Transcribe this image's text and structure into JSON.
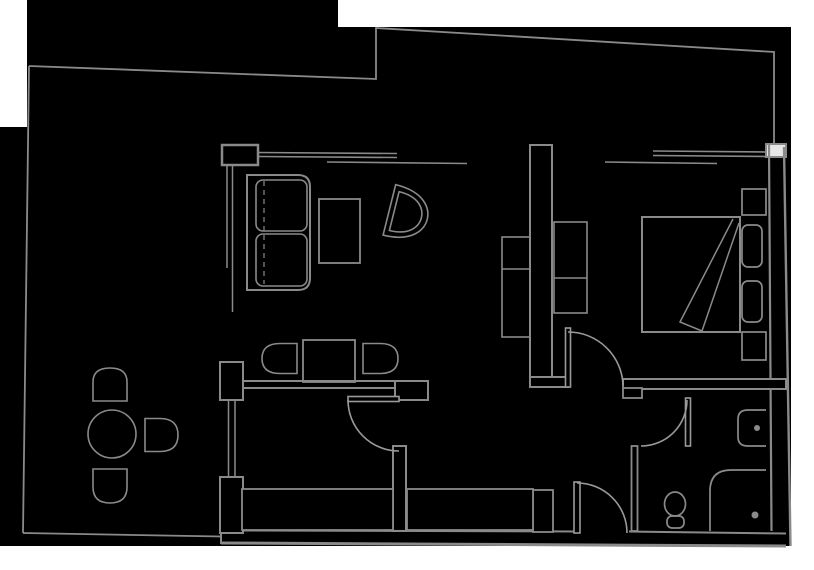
{
  "plan": {
    "title": "apartment-floor-plan",
    "background_color": "#000000",
    "margin_color": "#ffffff",
    "line_color": "#8a8a8a",
    "wall_fill_color": "#000000",
    "corner_block_fill": "#e6e6e6",
    "rooms": [
      {
        "name": "terrace",
        "side": "left"
      },
      {
        "name": "living-room",
        "side": "center-top"
      },
      {
        "name": "dining-hall",
        "side": "center"
      },
      {
        "name": "entry-hall",
        "side": "bottom-center"
      },
      {
        "name": "bedroom",
        "side": "right-top"
      },
      {
        "name": "bathroom",
        "side": "bottom-right"
      }
    ],
    "windows": [
      {
        "name": "living-room-window"
      },
      {
        "name": "bedroom-window"
      }
    ],
    "doors": [
      {
        "name": "terrace-glass-door"
      },
      {
        "name": "hall-door"
      },
      {
        "name": "bedroom-door"
      },
      {
        "name": "bathroom-door"
      },
      {
        "name": "entrance-door"
      }
    ],
    "furniture": [
      {
        "name": "sofa",
        "room": "living-room"
      },
      {
        "name": "coffee-table",
        "room": "living-room"
      },
      {
        "name": "armchair",
        "room": "living-room"
      },
      {
        "name": "living-cabinet",
        "room": "living-room"
      },
      {
        "name": "dining-table",
        "room": "dining-hall"
      },
      {
        "name": "dining-chair-left",
        "room": "dining-hall"
      },
      {
        "name": "dining-chair-right",
        "room": "dining-hall"
      },
      {
        "name": "entry-closet-left",
        "room": "entry-hall"
      },
      {
        "name": "entry-closet-right",
        "room": "entry-hall"
      },
      {
        "name": "double-bed",
        "room": "bedroom"
      },
      {
        "name": "pillow-top",
        "room": "bedroom"
      },
      {
        "name": "pillow-bottom",
        "room": "bedroom"
      },
      {
        "name": "nightstand-top",
        "room": "bedroom"
      },
      {
        "name": "nightstand-bottom",
        "room": "bedroom"
      },
      {
        "name": "wardrobe",
        "room": "bedroom"
      },
      {
        "name": "washbasin",
        "room": "bathroom"
      },
      {
        "name": "toilet",
        "room": "bathroom"
      },
      {
        "name": "shower",
        "room": "bathroom"
      },
      {
        "name": "terrace-round-table",
        "room": "terrace"
      },
      {
        "name": "terrace-chair-top",
        "room": "terrace"
      },
      {
        "name": "terrace-chair-right",
        "room": "terrace"
      },
      {
        "name": "terrace-chair-bottom",
        "room": "terrace"
      }
    ]
  }
}
